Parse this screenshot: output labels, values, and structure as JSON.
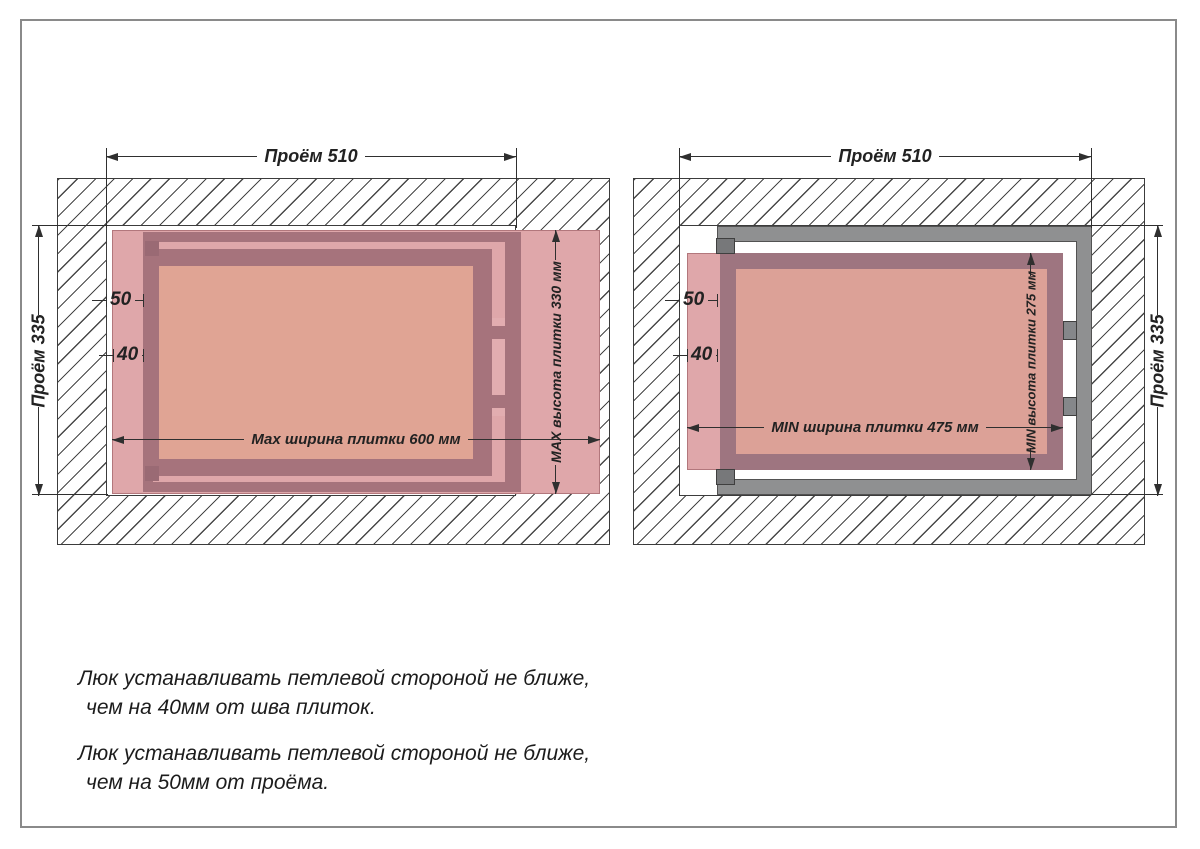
{
  "left_diagram": {
    "opening_width_label": "Проём 510",
    "opening_height_label": "Проём 335",
    "offset_from_opening": "50",
    "offset_from_seam": "40",
    "tile_width_label": "Мах ширина плитки 600 мм",
    "tile_height_label": "МАХ высота плитки 330 мм"
  },
  "right_diagram": {
    "opening_width_label": "Проём 510",
    "opening_height_label": "Проём 335",
    "offset_from_opening": "50",
    "offset_from_seam": "40",
    "tile_width_label": "MIN ширина плитки 475 мм",
    "tile_height_label": "MIN высота плитки 275 мм"
  },
  "notes": [
    {
      "line1": "Люк устанавливать петлевой стороной не ближе,",
      "line2": "чем на 40мм от шва плиток."
    },
    {
      "line1": "Люк устанавливать петлевой стороной не ближе,",
      "line2": "чем на 50мм от проёма."
    }
  ],
  "colors": {
    "tile_pink": "#dfa7aa",
    "frame_maroon": "#a6737c",
    "frame_maroon_right": "#9e7580",
    "door_panel": "#e0a494",
    "door_panel_right": "#dca197",
    "metal_gray": "#8f9091",
    "hinge_gray": "#77787a",
    "dimension_line": "#2f2f2f"
  }
}
